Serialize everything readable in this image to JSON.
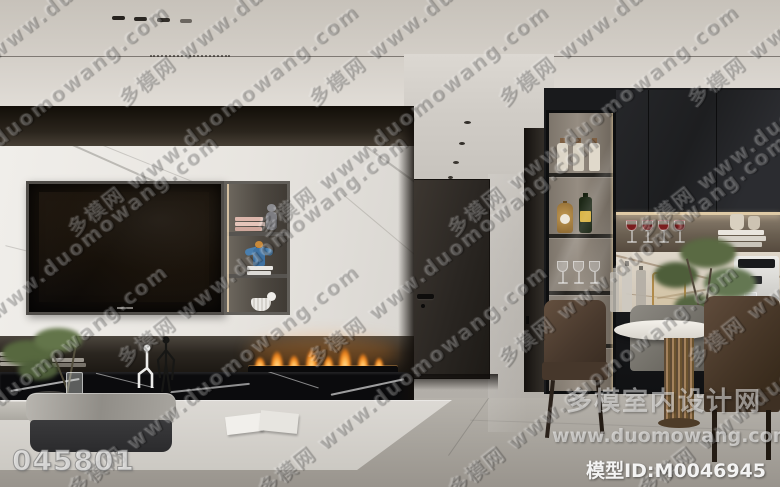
{
  "watermark": {
    "diagonal_text": "多模网 www.duomowang.com",
    "image_id": "045801",
    "site_name": "多模室内设计网",
    "site_url": "www.duomowang.com",
    "model_id_label": "模型ID:",
    "model_id": "M0046945"
  },
  "colors": {
    "ceiling": "#d2cdc6",
    "soffit_dark": "#241f19",
    "marble_wall": "#ece9e4",
    "fireplace_band": "#2b2620",
    "black_marble": "#0b0b0d",
    "flame_orange": "#f59b2e",
    "door": "#2b2723",
    "hallway_wall": "#bdb9b3",
    "cabinet_black": "#1e1f21",
    "niche_warm": "#6e6357",
    "backsplash_marble": "#d8d0c3",
    "bronze_table_base": "#8a6e50",
    "chair_brown": "#54423a",
    "chair_gray": "#7b7872",
    "plant_green": "#56663f",
    "floor": "#aaa69f",
    "rug": "#d6d3ce"
  }
}
